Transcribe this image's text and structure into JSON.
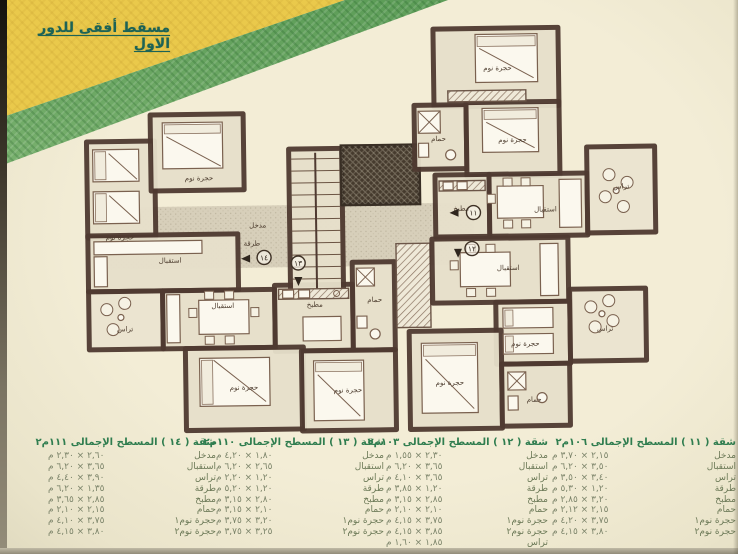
{
  "page": {
    "title": "مسقط أفقى للدور الاول"
  },
  "plan": {
    "room_labels": {
      "bedroom": "حجرة نوم",
      "reception": "استقبال",
      "terrace": "تراس",
      "kitchen": "مطبخ",
      "bath": "حمام",
      "hall": "طرقة",
      "entrance": "مدخل"
    },
    "units": [
      "١١",
      "١٢",
      "١٣",
      "١٤"
    ]
  },
  "tables": [
    {
      "apartment_no": "١٤",
      "title": "شقة ( ١٤ ) المسطح الإجمالى ١١١م٢",
      "rows": [
        {
          "room": "مدخل",
          "dims": "٢,٦٠ × ٢,٣٠ م"
        },
        {
          "room": "استقبال",
          "dims": "٣,٦٥ × ٦,٢٠ م"
        },
        {
          "room": "تراس",
          "dims": "٣,٩٠ × ٤,٤٠ م"
        },
        {
          "room": "طرقة",
          "dims": "١,٣٥ × ٦,٢٠ م"
        },
        {
          "room": "مطبخ",
          "dims": "٢,٨٥ × ٣,٦٥ م"
        },
        {
          "room": "حمام",
          "dims": "٢,١٥ × ٢,١٠ م"
        },
        {
          "room": "حجرة نوم١",
          "dims": "٣,٧٥ × ٤,١٠ م"
        },
        {
          "room": "حجرة نوم٢",
          "dims": "٣,٨٠ × ٤,١٥ م"
        }
      ]
    },
    {
      "apartment_no": "١٣",
      "title": "شقة ( ١٣ ) المسطح الإجمالى ١١٠م٢",
      "rows": [
        {
          "room": "مدخل",
          "dims": "١,٨٠ × ٤,٢٠ م"
        },
        {
          "room": "استقبال",
          "dims": "٢,٦٥ × ٦,٢٠ م"
        },
        {
          "room": "تراس",
          "dims": "١,٢٠ × ٢,٢٠ م"
        },
        {
          "room": "طرقة",
          "dims": "١,٢٠ × ٥,٢٠ م"
        },
        {
          "room": "مطبخ",
          "dims": "٢,٨٠ × ٣,١٥ م"
        },
        {
          "room": "حمام",
          "dims": "٢,١٠ × ٣,١٥ م"
        },
        {
          "room": "حجرة نوم١",
          "dims": "٣,٢٠ × ٣,٧٥ م"
        },
        {
          "room": "حجرة نوم٢",
          "dims": "٣,٢٥ × ٣,٧٥ م"
        }
      ]
    },
    {
      "apartment_no": "١٢",
      "title": "شقة ( ١٢ ) المسطح الإجمالى ١٠٣م٢",
      "rows": [
        {
          "room": "مدخل",
          "dims": "٢,٣٠ × ١,٥٥ م"
        },
        {
          "room": "استقبال",
          "dims": "٣,٦٥ × ٦,٢٠ م"
        },
        {
          "room": "تراس",
          "dims": "٣,٦٥ × ٤,١٠ م"
        },
        {
          "room": "طرقة",
          "dims": "١,٢٠ × ٣,٨٥ م"
        },
        {
          "room": "مطبخ",
          "dims": "٢,٨٥ × ٣,١٥ م"
        },
        {
          "room": "حمام",
          "dims": "٢,١٠ × ٢,١٠ م"
        },
        {
          "room": "حجرة نوم١",
          "dims": "٣,٧٥ × ٤,١٥ م"
        },
        {
          "room": "حجرة نوم٢",
          "dims": "٣,٨٥ × ٤,١٥ م"
        },
        {
          "room": "تراس",
          "dims": "١,٨٥ × ١,٦٠ م"
        }
      ]
    },
    {
      "apartment_no": "١١",
      "title": "شقة ( ١١ ) المسطح الإجمالى ١٠٦م٢",
      "rows": [
        {
          "room": "مدخل",
          "dims": "٢,١٥ × ٣,٧٠ م"
        },
        {
          "room": "استقبال",
          "dims": "٣,٥٠ × ٦,٢٠ م"
        },
        {
          "room": "تراس",
          "dims": "٣,٤٠ × ٣,٥٠ م"
        },
        {
          "room": "طرقة",
          "dims": "١,٢٠ × ٥,٣٠ م"
        },
        {
          "room": "مطبخ",
          "dims": "٣,٢٠ × ٢,٨٥ م"
        },
        {
          "room": "حمام",
          "dims": "٢,١٥ × ٢,١٢ م"
        },
        {
          "room": "حجرة نوم١",
          "dims": "٣,٧٥ × ٤,٢٠ م"
        },
        {
          "room": "حجرة نوم٢",
          "dims": "٣,٨٠ × ٤,١٥ م"
        }
      ]
    }
  ],
  "colors": {
    "ribbon_yellow": "#eac94b",
    "ribbon_green": "#74ad6b",
    "title_green": "#1c6356",
    "table_header_green": "#2f7d4f",
    "wall_brown": "#4f3a31",
    "page_cream": "#f0ead2"
  }
}
